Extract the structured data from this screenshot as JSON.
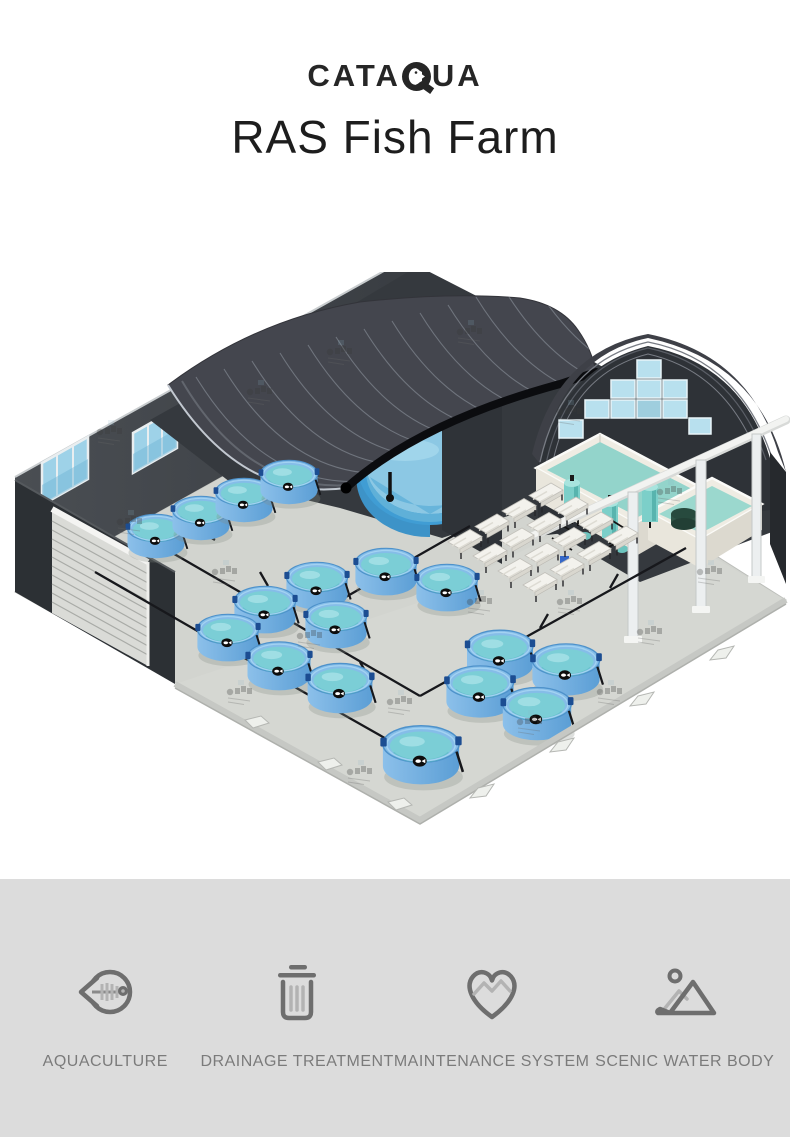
{
  "header": {
    "brand": "CATAQUA",
    "brand_prefix": "CATA",
    "brand_suffix": "UA",
    "title": "RAS Fish Farm"
  },
  "illustration": {
    "alt": "Isometric 3D rendering of an indoor RAS fish farm: dark arched warehouse with windows, rows of round blue fish tanks, a large circular pond, white filtration equipment room with teal filter cylinders, raceway trays, pipework and support columns",
    "components": [
      "warehouse-arched-roof",
      "secondary-arched-roof",
      "window-wall",
      "louver-vent",
      "circular-fish-tanks",
      "scenic-pond",
      "filtration-room",
      "filter-cylinders",
      "raceway-trays",
      "floor-piping",
      "support-columns"
    ],
    "colors": {
      "floor": "#d2d4cf",
      "wall_dark": "#34383d",
      "roof_dark": "#44464e",
      "tank_blue": "#6fadde",
      "tank_water": "#7bced6",
      "pond_blue": "#409dd4",
      "equipment_white": "#efece3",
      "filter_teal": "#7ccfc9"
    }
  },
  "features": [
    {
      "icon": "fish-icon",
      "label": "AQUACULTURE"
    },
    {
      "icon": "trash-icon",
      "label": "DRAINAGE TREATMENT"
    },
    {
      "icon": "heart-pulse-icon",
      "label": "MAINTENANCE SYSTEM"
    },
    {
      "icon": "mountain-icon",
      "label": "SCENIC WATER BODY"
    }
  ],
  "palette": {
    "footer_bg": "#dcdcdc",
    "icon_dark": "#6e6e6e",
    "icon_light": "#b3b3b3",
    "label_gray": "#7b7b7b",
    "text_dark": "#262626"
  }
}
